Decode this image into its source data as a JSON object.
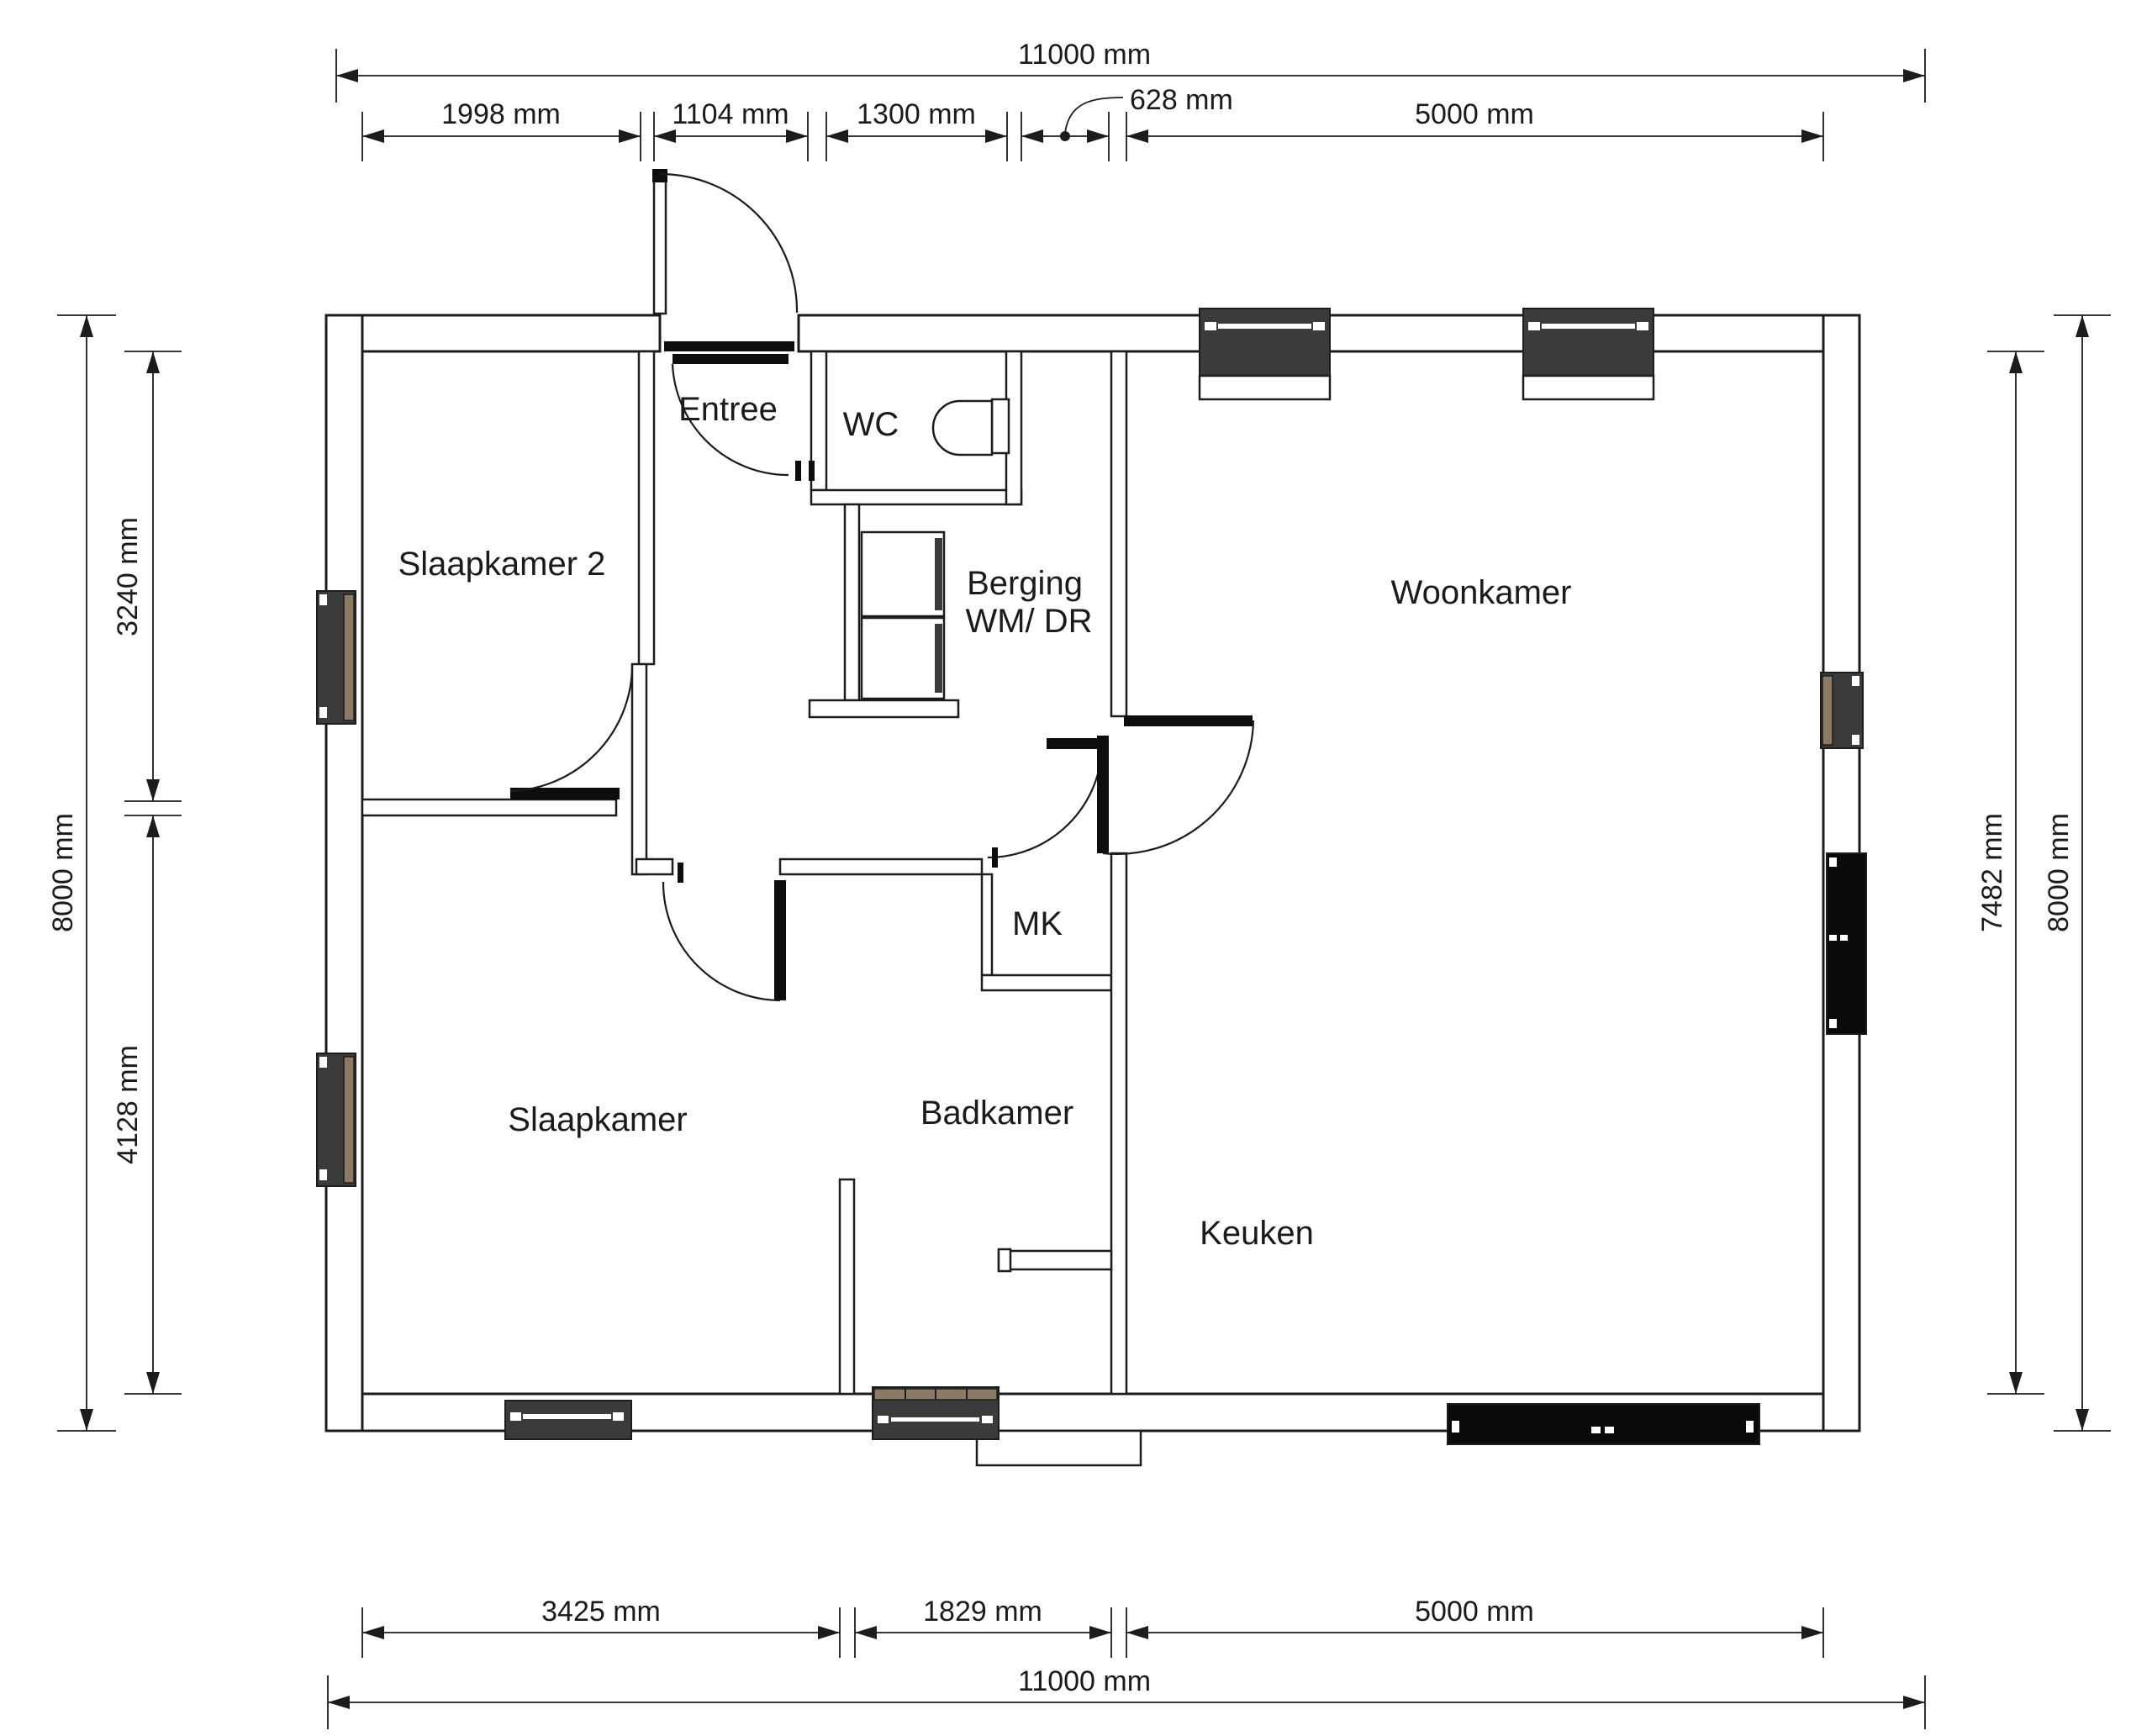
{
  "plan": {
    "type": "floor-plan",
    "language": "nl",
    "rooms": {
      "slaapkamer2": "Slaapkamer 2",
      "entree": "Entree",
      "wc": "WC",
      "berging_line1": "Berging",
      "berging_line2": "WM/ DR",
      "woonkamer": "Woonkamer",
      "mk": "MK",
      "slaapkamer": "Slaapkamer",
      "badkamer": "Badkamer",
      "keuken": "Keuken"
    },
    "dimensions": {
      "top_total": "11000 mm",
      "top_seg_1": "1998 mm",
      "top_seg_2": "1104 mm",
      "top_seg_3": "1300 mm",
      "top_seg_4": "628 mm",
      "top_seg_5": "5000 mm",
      "left_outer": "8000 mm",
      "left_seg_1": "3240 mm",
      "left_seg_2": "4128 mm",
      "right_inner": "7482 mm",
      "right_outer": "8000 mm",
      "bottom_seg_1": "3425 mm",
      "bottom_seg_2": "1829 mm",
      "bottom_seg_3": "5000 mm",
      "bottom_total": "11000 mm"
    },
    "colors": {
      "wall_stroke": "#1c1c1c",
      "window_fill": "#3b3b3b",
      "window_frame_brown": "#8c7b64",
      "sliding_door_fill": "#0a0a0a"
    }
  }
}
